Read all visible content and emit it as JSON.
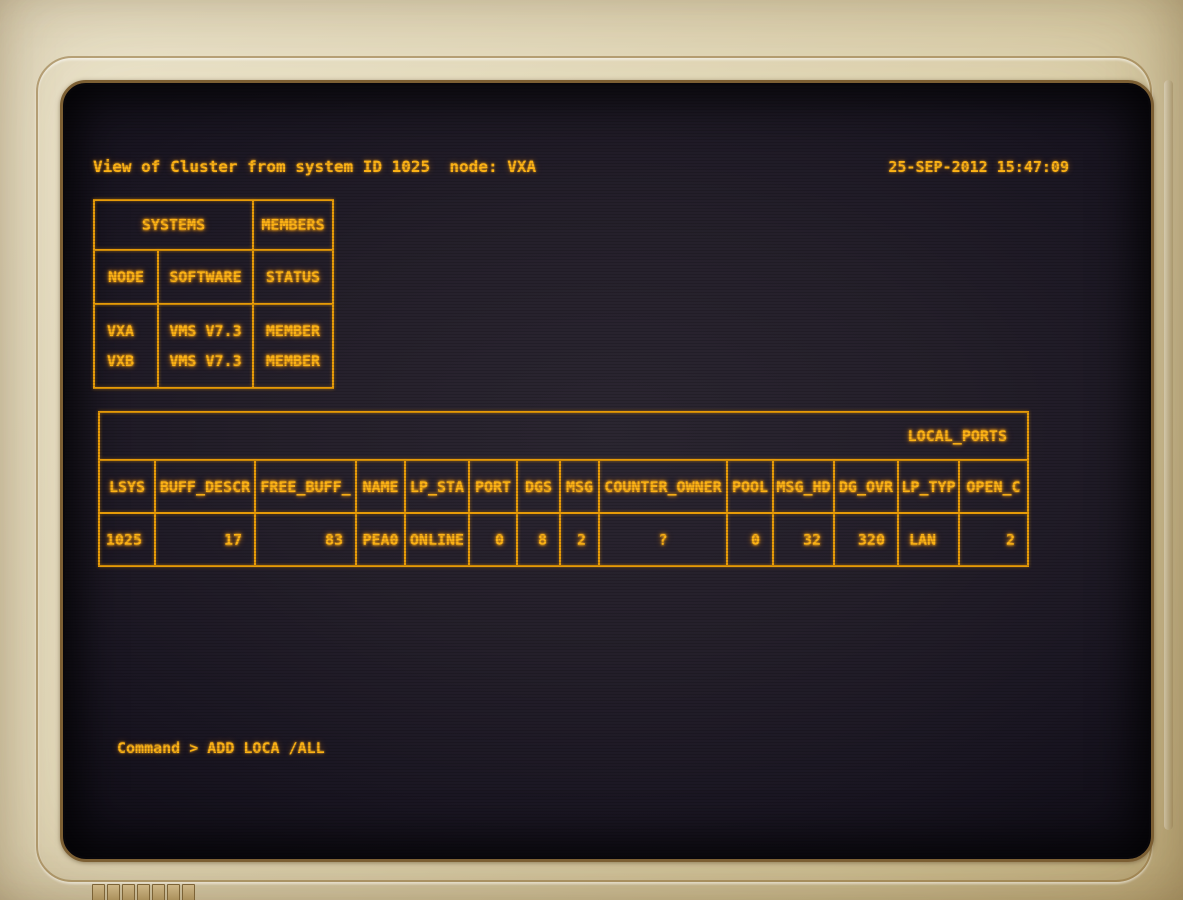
{
  "header": {
    "title": "View of Cluster from system ID 1025  node: VXA",
    "timestamp": "25-SEP-2012 15:47:09"
  },
  "systems_table": {
    "group_headers": [
      "SYSTEMS",
      "MEMBERS"
    ],
    "columns": [
      "NODE",
      "SOFTWARE",
      "STATUS"
    ],
    "rows": [
      {
        "node": "VXA",
        "software": "VMS V7.3",
        "status": "MEMBER"
      },
      {
        "node": "VXB",
        "software": "VMS V7.3",
        "status": "MEMBER"
      }
    ]
  },
  "local_ports": {
    "title": "LOCAL_PORTS",
    "columns": [
      "LSYS",
      "BUFF_DESCR",
      "FREE_BUFF_",
      "NAME",
      "LP_STA",
      "PORT",
      "DGS",
      "MSG",
      "COUNTER_OWNER",
      "POOL",
      "MSG_HD",
      "DG_OVR",
      "LP_TYP",
      "OPEN_C"
    ],
    "row": [
      "1025",
      "17",
      "83",
      "PEA0",
      "ONLINE",
      "0",
      "8",
      "2",
      "?",
      "0",
      "32",
      "320",
      "LAN",
      "2"
    ]
  },
  "command": {
    "prompt": "Command >",
    "input": "ADD LOCA /ALL"
  },
  "colors": {
    "phosphor": "#fcb216",
    "table_line": "#e79b08",
    "screen_bg": "#241f2a",
    "bezel": "#e0d5b2"
  }
}
